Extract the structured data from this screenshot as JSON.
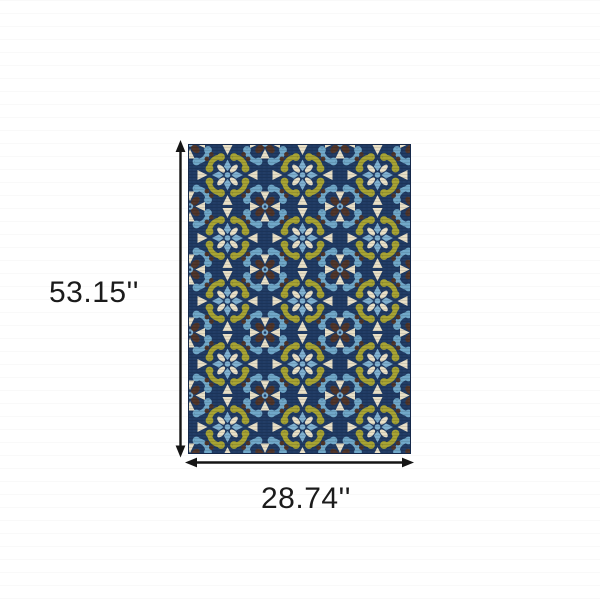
{
  "diagram": {
    "title": "rug dimension diagram",
    "height_label": "53.15''",
    "width_label": "28.74''"
  },
  "icons": {
    "height_arrow": "double-headed-vertical-arrow",
    "width_arrow": "double-headed-horizontal-arrow"
  },
  "rug": {
    "pattern": "alternating olive-green and light-blue scroll quatrefoil medallions with flower centers, cream triangle accents and dark brown curls on a navy field",
    "colors": {
      "navy_background": "#1f3a63",
      "olive_green": "#a6a232",
      "light_blue": "#6fa7c8",
      "flower_blue": "#7fb0d0",
      "cream": "#e8dfc6",
      "dark_brown": "#4e3429",
      "dimension_line": "#151515"
    }
  }
}
